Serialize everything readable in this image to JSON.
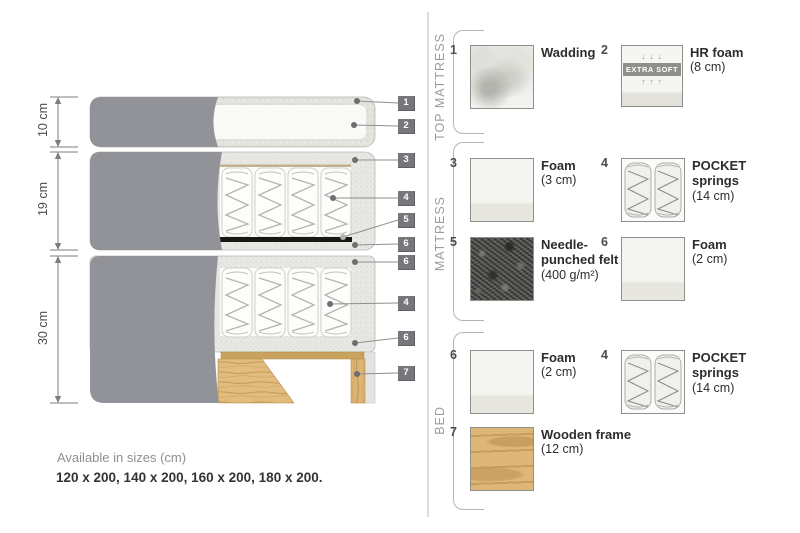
{
  "colors": {
    "fabric_gray": "#929399",
    "foam_texture": "#e7e8e4",
    "wood": "#ddb678",
    "tag_bg": "#76777b",
    "felt_black": "#171715"
  },
  "diagram": {
    "measurements": [
      {
        "label": "10 cm"
      },
      {
        "label": "19 cm"
      },
      {
        "label": "30 cm"
      }
    ],
    "tags": [
      {
        "num": "1"
      },
      {
        "num": "2"
      },
      {
        "num": "3"
      },
      {
        "num": "4"
      },
      {
        "num": "5"
      },
      {
        "num": "6"
      },
      {
        "num": "6"
      },
      {
        "num": "4"
      },
      {
        "num": "6"
      },
      {
        "num": "7"
      }
    ]
  },
  "legend": {
    "sections": [
      {
        "label": "TOP MATTRESS",
        "items": [
          {
            "num": "1",
            "name": "Wadding",
            "detail": "",
            "texture": "wadding"
          },
          {
            "num": "2",
            "name": "HR foam",
            "detail": "(8 cm)",
            "texture": "hr-foam",
            "badge": {
              "top_arrows": "↓ ↓ ↓",
              "text": "EXTRA SOFT",
              "bottom_arrows": "↑ ↑ ↑"
            }
          }
        ]
      },
      {
        "label": "MATTRESS",
        "items": [
          {
            "num": "3",
            "name": "Foam",
            "detail": "(3 cm)",
            "texture": "foam"
          },
          {
            "num": "4",
            "name": "POCKET springs",
            "detail": "(14 cm)",
            "texture": "pocket-springs"
          },
          {
            "num": "5",
            "name": "Needle-punched felt",
            "detail": "(400 g/m²)",
            "texture": "felt"
          },
          {
            "num": "6",
            "name": "Foam",
            "detail": "(2 cm)",
            "texture": "foam"
          }
        ]
      },
      {
        "label": "BED",
        "items": [
          {
            "num": "6",
            "name": "Foam",
            "detail": "(2 cm)",
            "texture": "foam"
          },
          {
            "num": "4",
            "name": "POCKET springs",
            "detail": "(14 cm)",
            "texture": "pocket-springs"
          },
          {
            "num": "7",
            "name": "Wooden frame",
            "detail": "(12 cm)",
            "texture": "wood"
          }
        ]
      }
    ]
  },
  "footer": {
    "title": "Available in sizes (cm)",
    "sizes": "120 x 200, 140 x 200, 160 x 200, 180 x 200."
  }
}
